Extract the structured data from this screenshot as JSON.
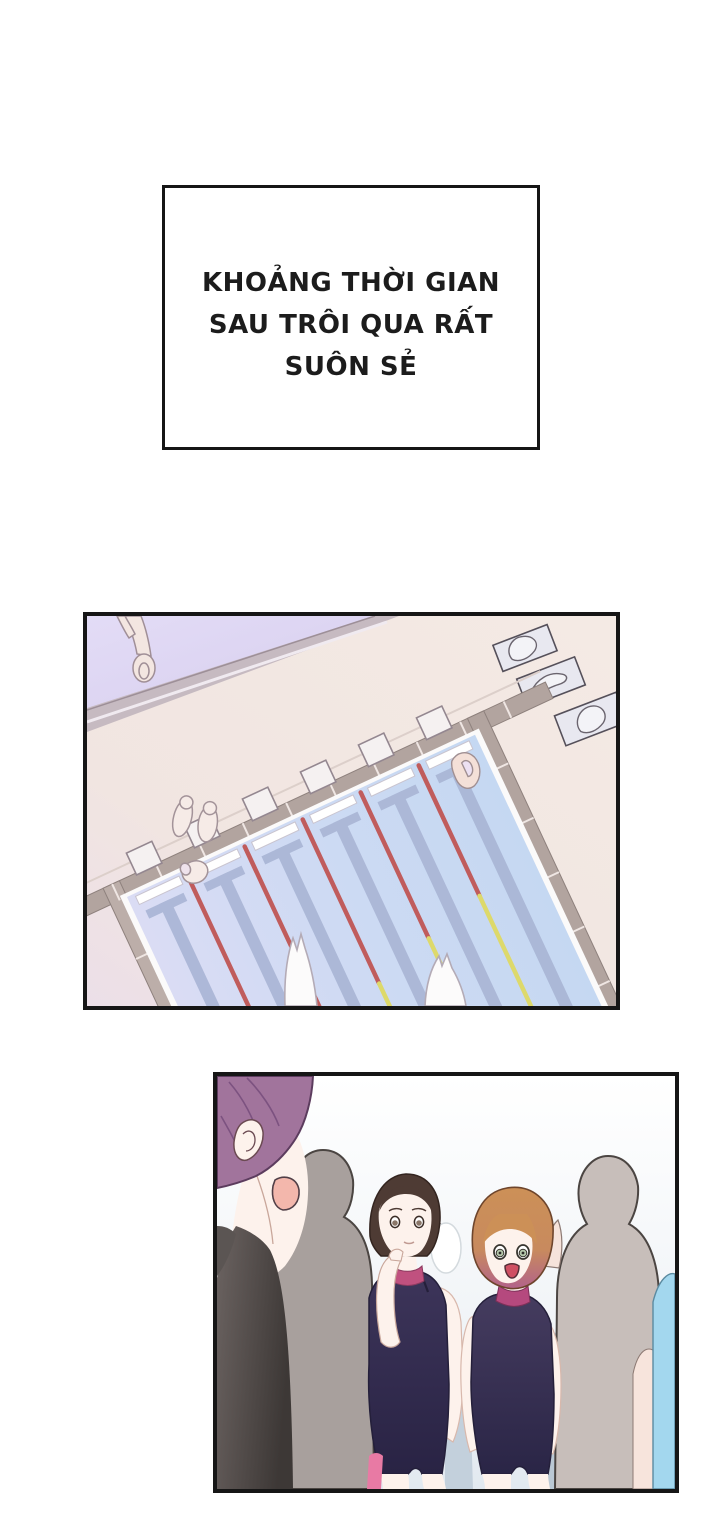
{
  "caption": {
    "text": "KHOẢNG THỜI GIAN\nSAU TRÔI QUA RẤT\nSUÔN SẺ"
  },
  "pool_scene": {
    "name": "overhead-swimming-pool",
    "elements": [
      "pool-water",
      "lane-ropes",
      "lane-target-marks",
      "starting-blocks",
      "deck",
      "low-wall",
      "towels",
      "bystanders",
      "swimmer-splashes"
    ],
    "lanes": 6,
    "colors": {
      "deck": "#f3e8e3",
      "deck_shadow": "#ecdfe7",
      "floor_beyond_wall": "#dcd4f0",
      "wall_strip": "#c6bac1",
      "pool_edging": "#b2a49f",
      "water_left": "#d9dbf4",
      "water_right": "#c6d8f2",
      "lane_mark": "#a9b5d5",
      "rope_red": "#c05c5c",
      "rope_yellow": "#ddd96b",
      "towel": "#e8e8f0",
      "splash": "#fcfbfb"
    }
  },
  "crowd_scene": {
    "name": "swimmers-and-silhouettes",
    "elements": [
      "foreground-man",
      "silhouette-left",
      "silhouette-right",
      "girl-bun",
      "girl-bob",
      "background-legs"
    ],
    "colors": {
      "bg_top": "#ffffff",
      "bg_bottom": "#e2e9f0",
      "silhouette_dark": "#a8a09d",
      "silhouette_light": "#c7beba",
      "strip_bluegray": "#c3d0dc",
      "man_hair": "#a1749c",
      "man_top": "#4a4442",
      "skin": "#fdf2ec",
      "mouth_pink": "#f3b7ac",
      "girl1_hair": "#4e3b34",
      "girl2_hair": "#cc9057",
      "girl2_hair_tip": "#b2638a",
      "swimsuit_navy": "#342d50",
      "collar_magenta": "#bf4f83",
      "accent_pink": "#e87aa4",
      "accent_blue": "#a3d7ee"
    }
  }
}
